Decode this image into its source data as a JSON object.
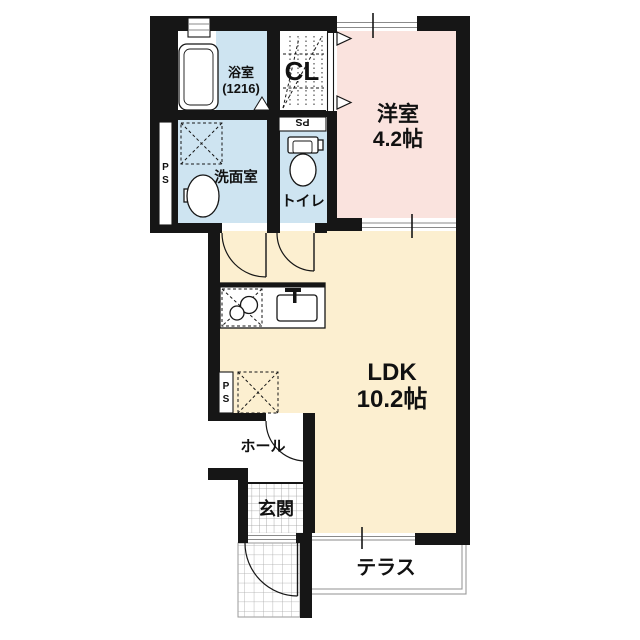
{
  "plan": {
    "rooms": {
      "bath": {
        "label": "浴室",
        "size": "(1216)"
      },
      "closet": {
        "label": "CL"
      },
      "washroom": {
        "label": "洗面室"
      },
      "toilet": {
        "label": "トイレ"
      },
      "western_room": {
        "label": "洋室",
        "size": "4.2帖"
      },
      "ldk": {
        "label": "LDK",
        "size": "10.2帖"
      },
      "hall": {
        "label": "ホール"
      },
      "entrance": {
        "label": "玄関"
      },
      "terrace": {
        "label": "テラス"
      }
    },
    "labels": {
      "pipe_space": "PS",
      "pipe_space_chars": [
        "P",
        "S"
      ]
    },
    "colors": {
      "wall": "#161616",
      "western_room_fill": "#FAE3DE",
      "ldk_fill": "#FCEFD0",
      "wet_area_fill": "#CEE4F1"
    }
  }
}
